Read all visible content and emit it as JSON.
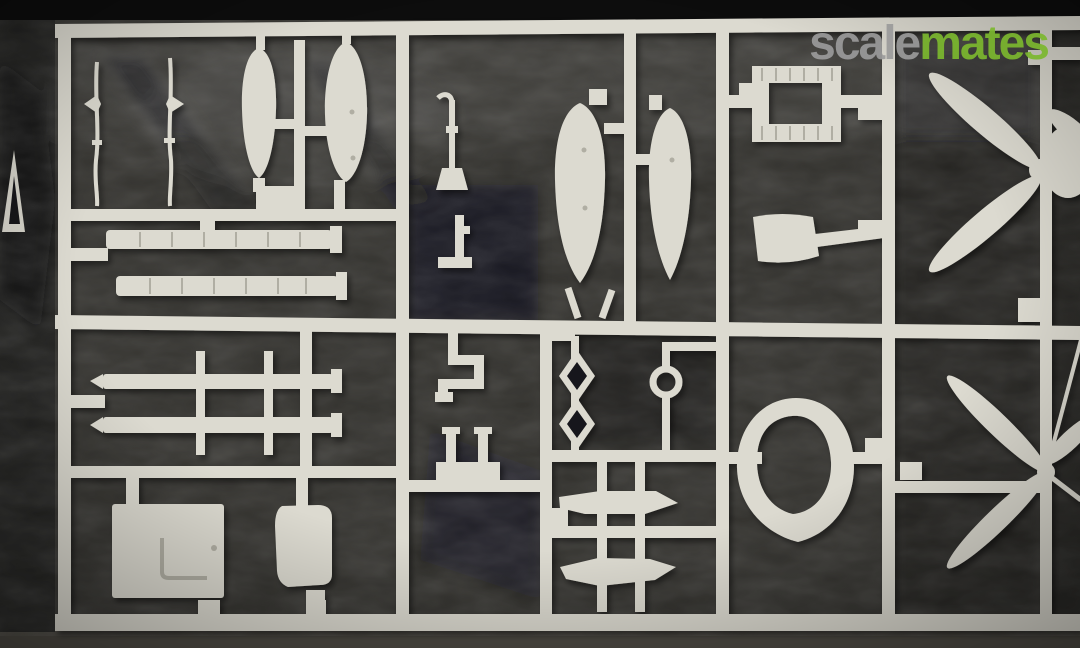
{
  "image": {
    "type": "photograph",
    "subject": "Injection-moulded plastic model kit sprue (light grey styrene parts frame) photographed on dark charcoal cloth",
    "orientation": "landscape"
  },
  "watermark": {
    "part1": "scale",
    "part2": "mates"
  },
  "sprue": {
    "plastic_color_name": "light grey",
    "edge_label": "A",
    "parts": [
      "antenna mast (2)",
      "drop-tank half (2)",
      "exhaust/intake strip (2)",
      "bomb or fuel-tank half (2)",
      "rectangular frame part",
      "scoop / shovel-shaped part",
      "three-blade propeller",
      "two-blade propeller",
      "engine cowling ring",
      "wing spar rod with pegs (2)",
      "cockpit floor plate with hatch line",
      "access hatch door",
      "step bracket",
      "seat / U-bracket",
      "sway-brace diamond struts",
      "small wheel on strut",
      "stabilizer half (2)",
      "lever / faucet-shaped part",
      "inverted-T bracket"
    ]
  },
  "colors": {
    "bg": "#33322e",
    "bg_dark": "#17171a",
    "top_band": "#0d0d0d",
    "bottom_band": "#4e4b44",
    "sprue": "#dcdad0",
    "sprue_dark": "#b7b5aa",
    "part_detail": "#b0aea3",
    "letter": "#d6d4ca",
    "logo_gray": "#9b9b9b",
    "logo_green": "#7cb82f"
  }
}
